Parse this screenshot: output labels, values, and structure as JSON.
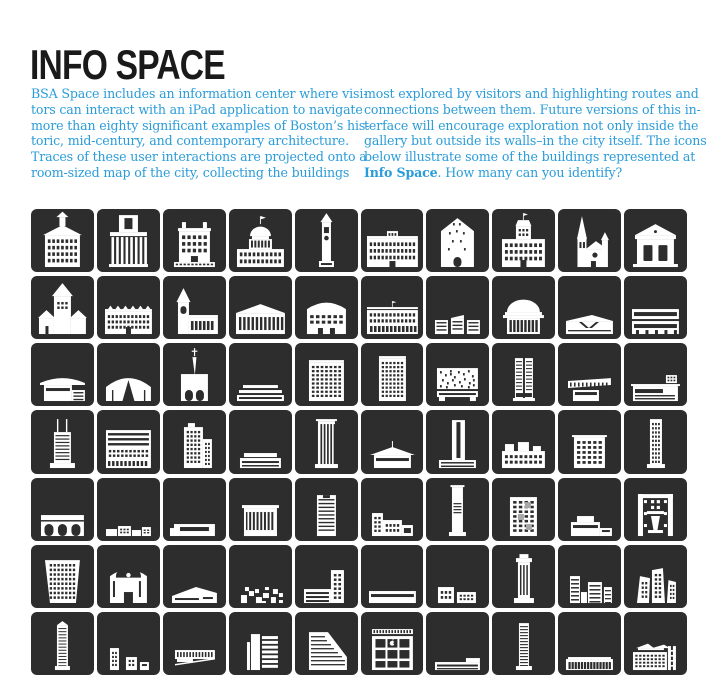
{
  "page": {
    "title": "INFO SPACE",
    "intro": {
      "left_lines": [
        "BSA Space includes an information center where visi-",
        "tors can interact with an iPad application to navigate",
        "more than eighty significant examples of Boston’s his-",
        "toric, mid-century, and contemporary architecture.",
        "Traces of these user interactions are projected onto a",
        "room-sized map of the city, collecting the buildings"
      ],
      "right_lines": [
        "most explored by visitors and highlighting routes and",
        "connections between them. Future versions of this in-",
        "terface will encourage exploration not only inside the",
        "gallery but outside its walls–in the city itself. The icons",
        "below illustrate some of the buildings represented at"
      ],
      "right_last_bold": "Info Space",
      "right_last_rest": ". How many can you identify?"
    }
  },
  "colors": {
    "accent_blue": "#2A9CD9",
    "title_black": "#1A1A1A",
    "tile_background": "#2D2D2D",
    "building_white": "#FFFFFF",
    "page_background": "#FFFFFF"
  },
  "grid": {
    "rows": 7,
    "cols": 10,
    "tile_count": 70,
    "tiles": [
      "cupola-hall",
      "market-portico",
      "georgian-mansion",
      "domed-statehouse",
      "clock-tower",
      "palace-facade",
      "gabled-warehouse",
      "mansard-city-hall",
      "gothic-cathedral",
      "greek-temple",
      "romanesque-church",
      "rowhouse-block",
      "steepled-church",
      "market-hall",
      "theater-facade",
      "colonnade-hotel",
      "cube-trio",
      "great-dome",
      "angular-pavilion",
      "ribbon-slab",
      "curved-pavilion",
      "vault-arena",
      "spired-church",
      "low-terminal",
      "grid-block-tall",
      "floorline-block",
      "perforated-garage",
      "twin-tower",
      "cantilever-museum",
      "canopy-retail",
      "mast-tower",
      "banded-slab",
      "stepped-midrise",
      "long-low-slab",
      "channel-tower",
      "winged-pavilion",
      "slab-on-base",
      "monitor-hall",
      "grid-block",
      "slender-grid-tower",
      "arch-garage",
      "campus-cluster",
      "band-slab",
      "finned-block",
      "striped-midrise",
      "stepped-complex",
      "slender-slab",
      "paneled-midrise",
      "stepped-lowrise",
      "portal-arch",
      "cityhall-ziggurat",
      "fan-theater",
      "angular-lowrise",
      "block-cluster",
      "tower-and-wing",
      "banded-lowrise",
      "block-pair",
      "crowned-tower",
      "louvered-cluster",
      "decon-towers",
      "slender-highrise",
      "small-cluster",
      "cantilever-box",
      "core-office",
      "wedge-tower",
      "apple-store",
      "long-lowrise",
      "floorline-tower",
      "window-slab",
      "framework-complex"
    ]
  }
}
